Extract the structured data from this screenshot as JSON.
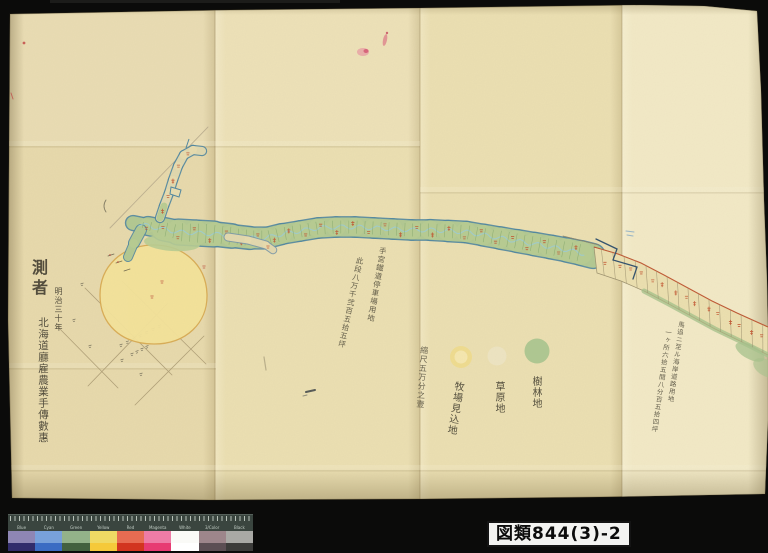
{
  "scan": {
    "archive_label": "図類844(3)-2",
    "colors": {
      "background": "#0b0b0a",
      "paper": "#ebdfb2"
    }
  },
  "map": {
    "title_block": {
      "heading": "測者",
      "date": "明治三十年",
      "surveyor": "北海道廳雇農業手傳數惠"
    },
    "notes": {
      "railway_note_1": "手宮鐵道停車場用地",
      "railway_note_2": "此段八万千弐百五拾五坪",
      "coast_note_1": "馬追ニ至ル海岸道路用地",
      "coast_note_2": "一ヶ所六拾五間八分百五拾四坪",
      "scale_note": "縮尺五万分之壹"
    },
    "legend": [
      {
        "label": "樹林地",
        "swatch_color": "#9fc08a"
      },
      {
        "label": "草原地",
        "swatch_color": "#f0e9d2"
      },
      {
        "label": "牧場見込地",
        "swatch_color": "#f0dc8a"
      }
    ],
    "colors": {
      "strip_fill": "#b7cc92",
      "strip_outline": "#4f86a0",
      "stream": "#9ccdd5",
      "red_mark": "#c0502c",
      "road_red": "#c2512e",
      "pasture_fill": "#f4e39a",
      "pasture_outline": "#d8aa52",
      "grid_line": "#b0a078",
      "parcel_line": "#9a8f6d",
      "ink": "#3f3b2e"
    }
  },
  "color_bar": {
    "ruler_labels": [
      "Blue",
      "Cyan",
      "Green",
      "Yellow",
      "Red",
      "Magenta",
      "White",
      "3/Color",
      "Black"
    ],
    "patches": [
      {
        "top": "#8e86b4",
        "bottom": "#312c6b"
      },
      {
        "top": "#78a1da",
        "bottom": "#3b6cc3"
      },
      {
        "top": "#93b289",
        "bottom": "#43613f"
      },
      {
        "top": "#efd964",
        "bottom": "#f5c93a"
      },
      {
        "top": "#e76c52",
        "bottom": "#d2351f"
      },
      {
        "top": "#ee7ca6",
        "bottom": "#e73b72"
      },
      {
        "top": "#fafaf7",
        "bottom": "#ffffff"
      },
      {
        "top": "#9d868b",
        "bottom": "#5c4f54"
      },
      {
        "top": "#a9a9a5",
        "bottom": "#3c3c3a"
      }
    ]
  }
}
